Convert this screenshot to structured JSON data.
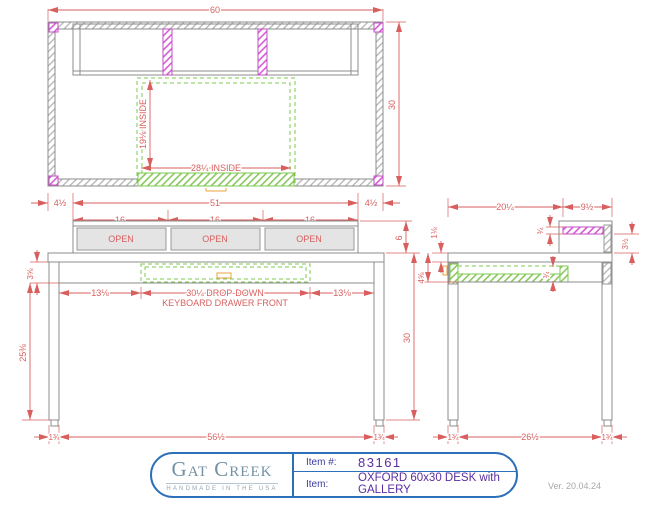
{
  "colors": {
    "dimension_red": "#d95f5f",
    "hatch_gray": "#b9b9b9",
    "hatch_magenta": "#d45fd4",
    "hatch_green": "#7ec850",
    "pull_orange": "#e8a33d",
    "titleblock_blue": "#2e6fba",
    "item_purple": "#5a2da0",
    "label_navy": "#3b3b9e",
    "logo_gray_blue": "#7491a3"
  },
  "top": {
    "overall_width": "60",
    "overall_depth": "30",
    "inside_width": "28¼ INSIDE",
    "inside_depth": "19⅛ INSIDE"
  },
  "gallery": {
    "offset_left": "4½",
    "width": "51",
    "offset_right": "4½",
    "cubby_1": "16",
    "cubby_2": "16",
    "cubby_3": "16",
    "open_1": "OPEN",
    "open_2": "OPEN",
    "open_3": "OPEN",
    "height": "6",
    "shelf_thickness": "¾",
    "opening_height": "3½"
  },
  "front": {
    "apron_height": "3⅝",
    "knee_clearance": "25⅜",
    "height": "30",
    "gap_left": "13⅛",
    "drawer_line_1": "30¼ DROP-DOWN",
    "drawer_line_2": "KEYBOARD DRAWER FRONT",
    "gap_right": "13⅛",
    "leg_left": "1¾",
    "between_legs": "56½",
    "leg_right": "1¾"
  },
  "side": {
    "top_depth": "20¼",
    "gallery_depth": "9½",
    "top_thickness": "1⅛",
    "apron_depth": "4⅝",
    "drawer_thickness": "¾",
    "leg_front": "1¾",
    "between_legs": "26½",
    "leg_back": "1¾"
  },
  "title_block": {
    "brand": "Gat Creek",
    "tagline": "HANDMADE IN THE USA",
    "item_no_label": "Item #:",
    "item_no": "83161",
    "item_label": "Item:",
    "item_desc": "OXFORD 60x30 DESK with GALLERY"
  },
  "version": "Ver. 20.04.24"
}
